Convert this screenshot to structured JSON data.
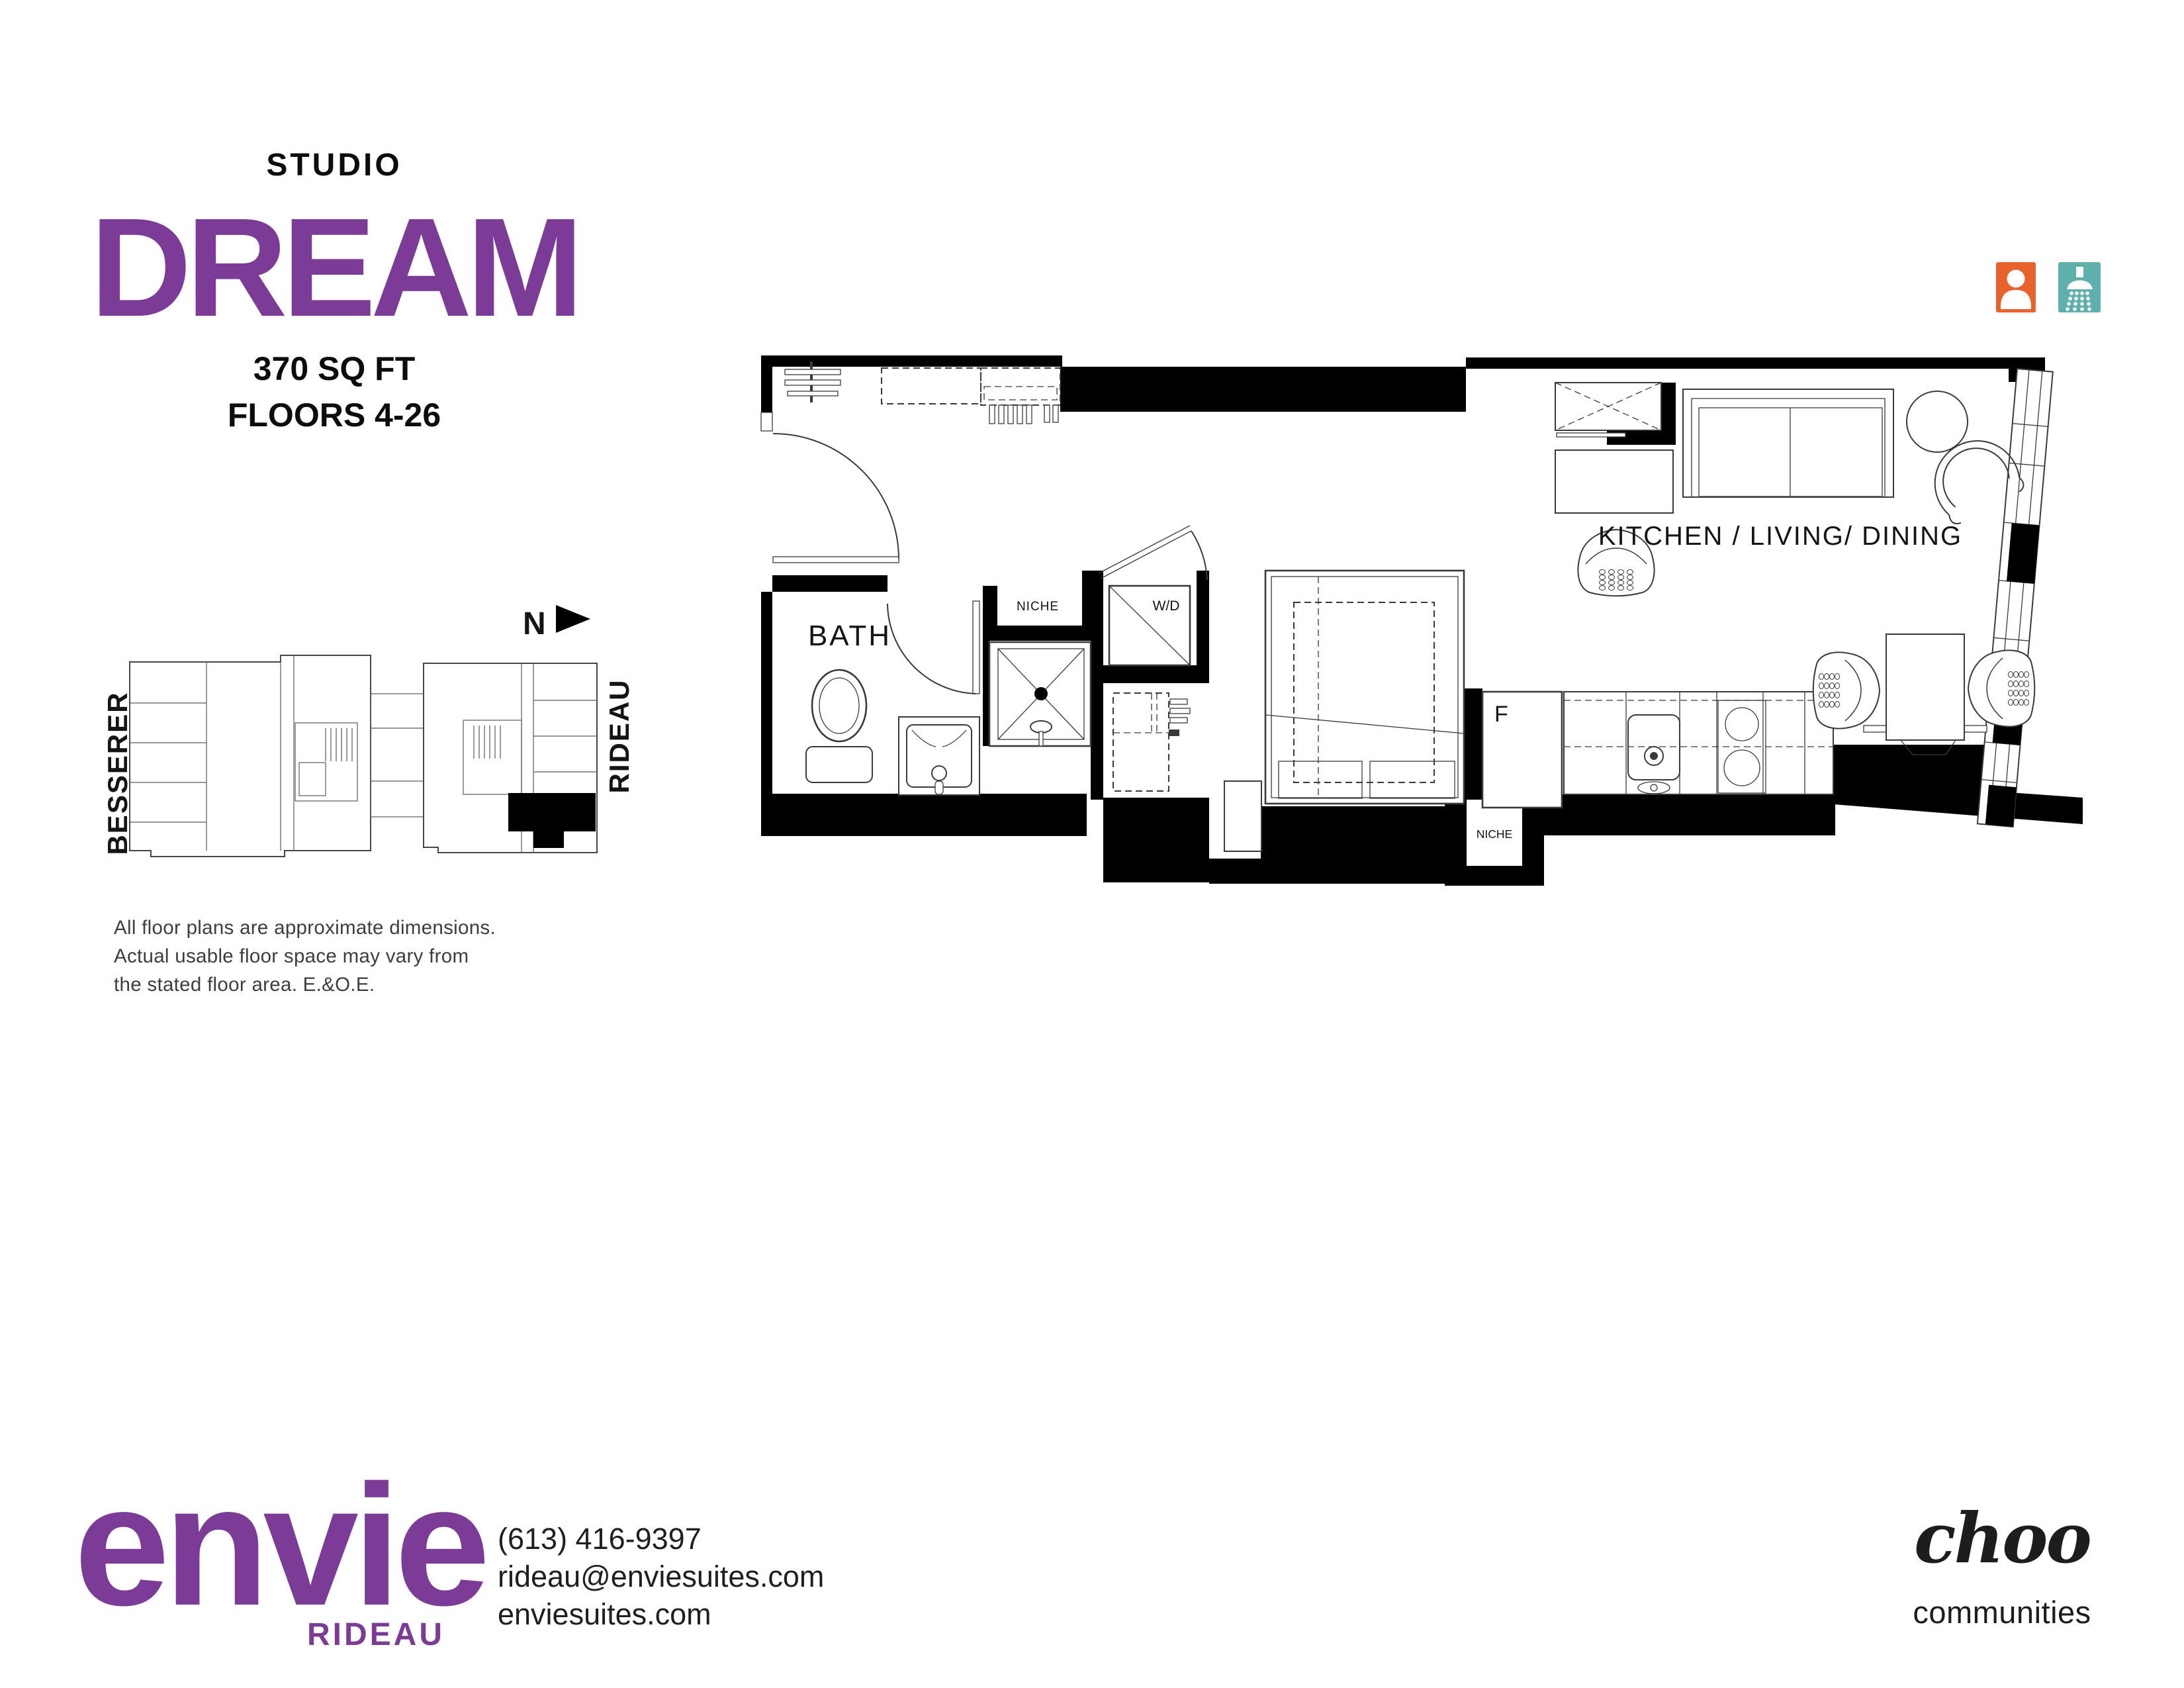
{
  "header": {
    "unit_type": "STUDIO",
    "unit_name": "DREAM",
    "area": "370 SQ FT",
    "floors": "FLOORS 4-26"
  },
  "key_plan": {
    "north_label": "N",
    "street_left": "BESSERER",
    "street_right": "RIDEAU"
  },
  "disclaimer": {
    "line1": "All floor plans are approximate dimensions.",
    "line2": "Actual usable floor space may vary from",
    "line3": "the stated floor area. E.&O.E."
  },
  "plan": {
    "bath": "BATH",
    "niche_upper": "NICHE",
    "wd": "W/D",
    "fridge": "F",
    "niche_lower": "NICHE",
    "main_room": "KITCHEN / LIVING/ DINING"
  },
  "footer": {
    "brand": "envie",
    "brand_location": "RIDEAU",
    "phone": "(613) 416-9397",
    "email": "rideau@enviesuites.com",
    "website": "enviesuites.com",
    "developer_script": "choo",
    "developer_word": "communities"
  },
  "colors": {
    "purple": "#7B3B96",
    "orange": "#E8622D",
    "teal": "#5FB0AD",
    "wall_black": "#000000"
  }
}
